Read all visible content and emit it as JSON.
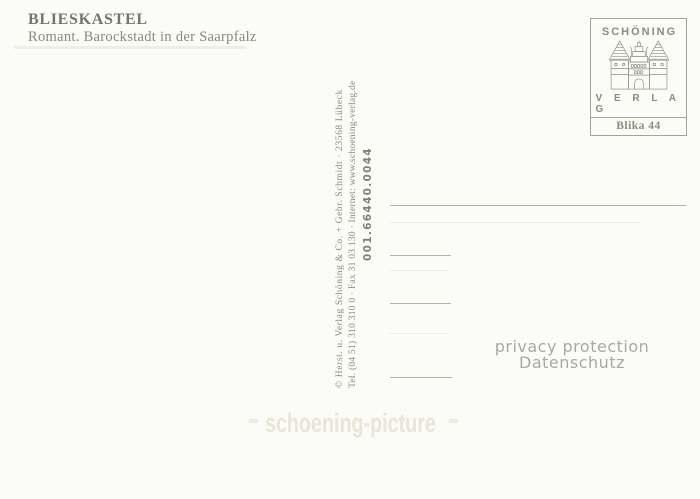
{
  "card": {
    "title": "BLIESKASTEL",
    "subtitle": "Romant. Barockstadt in der Saarpfalz"
  },
  "stamp_box": {
    "brand": "SCHÖNING",
    "brand_sub": "V E R L A G",
    "series_code": "Blika 44",
    "logo_icon": "holstentor-gate-icon"
  },
  "imprint": {
    "publisher_line": "© Herst. u. Verlag Schöning & Co. + Gebr. Schmidt · 23568 Lübeck",
    "contact_line": "Tel. (04 51) 310 310 0 · Fax 31 03 130 · Internet: www.schoening-verlag.de",
    "order_number": "001.66440.0044"
  },
  "privacy_notice": {
    "line1": "privacy protection",
    "line2": "Datenschutz"
  },
  "watermark": {
    "label": "schoening-picture"
  },
  "address_block": {
    "line_count": 4
  },
  "colors": {
    "background": "#fbfbf7",
    "header_ink": "#76756a",
    "imprint_ink": "#8d8b7e",
    "stamp_ink": "#8d8b7b",
    "address_line": "#b6b3a3",
    "privacy_text": "#a8a8a8",
    "watermark_text": "#e9e6d7"
  }
}
